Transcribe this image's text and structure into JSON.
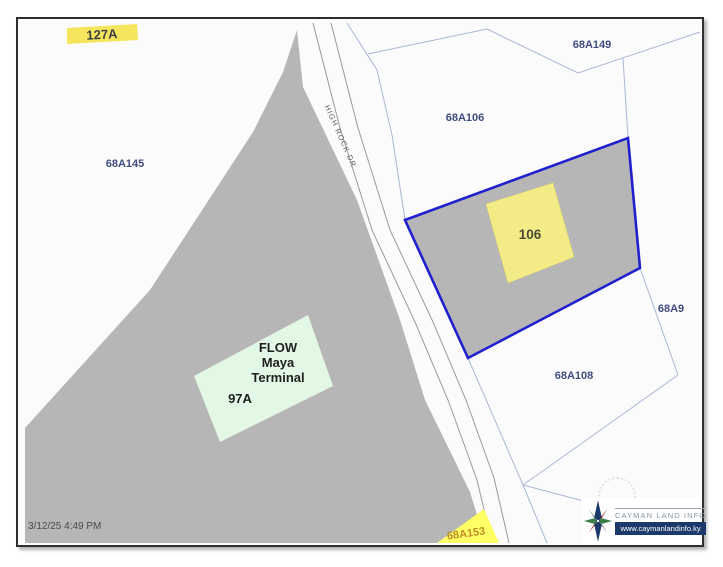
{
  "map": {
    "timestamp": "3/12/25 4:49 PM",
    "road_label": "HIGH ROCK DR",
    "parcels": {
      "p127a": {
        "label": "127A"
      },
      "p68a145": {
        "label": "68A145"
      },
      "p68a149": {
        "label": "68A149"
      },
      "p68a106": {
        "label": "68A106"
      },
      "p106": {
        "label": "106"
      },
      "p68a9": {
        "label": "68A9"
      },
      "p68a108": {
        "label": "68A108"
      },
      "p68a153": {
        "label": "68A153"
      },
      "p97a": {
        "label": "97A",
        "building_lines": [
          "FLOW",
          "Maya",
          "Terminal"
        ]
      }
    }
  },
  "branding": {
    "name": "CAYMAN LAND INFO",
    "website": "www.caymanlandinfo.ky"
  },
  "colors": {
    "map-bg": "#fbfbfb",
    "parcel-gray": "#b6b6b6",
    "selected-outline": "#2020cf",
    "building-yellow": "#f3eb85",
    "highlight-yellow": "#f4e55c",
    "flash-yellow": "#ffff66",
    "terminal-green": "#e3f7e5",
    "boundary-blue": "#a9b6d6",
    "label-blue": "#3e4d7d",
    "road-gray": "#9a9a9a",
    "brand-navy": "#1b3a6b"
  }
}
